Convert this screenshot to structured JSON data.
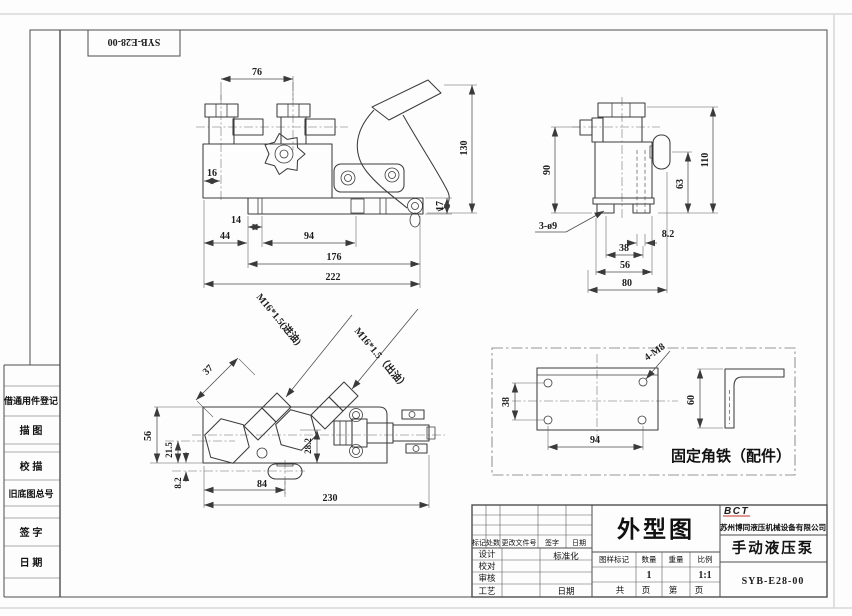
{
  "margin": {
    "part_no": "SYB-E28-00",
    "register": "借通用件登记",
    "tracing": "描 图",
    "check_tracing": "校 描",
    "old_drawing_no": "旧底图总号",
    "signature": "签 字",
    "date": "日 期"
  },
  "front_view": {
    "d76": "76",
    "d16": "16",
    "d14": "14",
    "d44": "44",
    "d94": "94",
    "d176": "176",
    "d222": "222",
    "d17": "17",
    "d130": "130"
  },
  "side_view": {
    "d90": "90",
    "d110": "110",
    "d63": "63",
    "holes": "3-ø9",
    "d8_2": "8.2",
    "d38": "38",
    "d56": "56",
    "d80": "80"
  },
  "top_view": {
    "d37": "37",
    "inlet": "M16*1.5(进油)",
    "outlet": "M16*1.5（出油）",
    "d56": "56",
    "d21_5": "21.5",
    "d8_2": "8.2",
    "d28_2": "28.2",
    "d84": "84",
    "d230": "230"
  },
  "bracket_view": {
    "d38": "38",
    "d94": "94",
    "d60": "60",
    "holes": "4-M8",
    "caption": "固定角铁（配件）"
  },
  "title_block": {
    "logo": "BCT",
    "company": "苏州博同液压机械设备有限公司",
    "drawing_title": "外型图",
    "product_name": "手动液压泵",
    "drawing_no": "SYB-E28-00",
    "rev": {
      "mark": "标记",
      "count": "处数",
      "change_doc": "更改文件号",
      "sign": "签字",
      "date": "日期"
    },
    "roles": {
      "design": "设计",
      "proof": "校对",
      "audit": "审核",
      "process": "工艺",
      "standard": "标准化",
      "date": "日期"
    },
    "grid": {
      "drawing_mark": "图样标记",
      "quantity_label": "数量",
      "weight_label": "重量",
      "scale_label": "比例",
      "quantity": "1",
      "scale": "1:1",
      "total": "共",
      "page1": "页",
      "no": "第",
      "page2": "页"
    }
  }
}
